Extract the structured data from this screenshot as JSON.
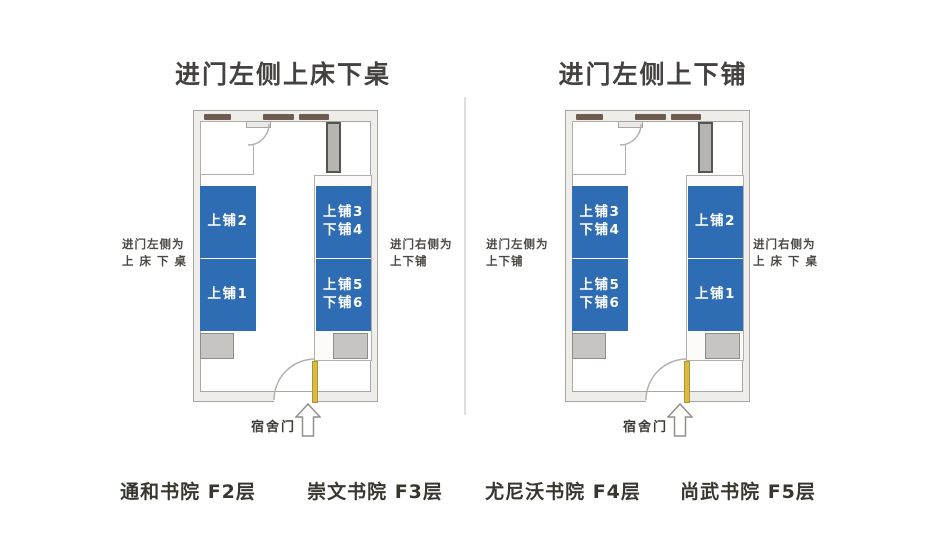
{
  "titles": {
    "left": "进门左侧上床下桌",
    "right": "进门左侧上下铺"
  },
  "rooms": [
    {
      "outer_label_left": {
        "line1": "进门左侧为",
        "line2": "上 床 下 桌"
      },
      "outer_label_right": {
        "line1": "进门右侧为",
        "line2": "上下铺"
      },
      "left_beds": [
        [
          "上铺2"
        ],
        [
          "上铺1"
        ]
      ],
      "right_beds": [
        [
          "上铺3",
          "下铺4"
        ],
        [
          "上铺5",
          "下铺6"
        ]
      ],
      "door_label": "宿舍门"
    },
    {
      "outer_label_left": {
        "line1": "进门左侧为",
        "line2": "上下铺"
      },
      "outer_label_right": {
        "line1": "进门右侧为",
        "line2": "上 床 下 桌"
      },
      "left_beds": [
        [
          "上铺3",
          "下铺4"
        ],
        [
          "上铺5",
          "下铺6"
        ]
      ],
      "right_beds": [
        [
          "上铺2"
        ],
        [
          "上铺1"
        ]
      ],
      "door_label": "宿舍门"
    }
  ],
  "captions": [
    "通和书院 F2层",
    "崇文书院 F3层",
    "尤尼沃书院 F4层",
    "尚武书院 F5层"
  ],
  "colors": {
    "bed_blue": "#2e6cb4",
    "desk_gray": "#c7c5c2",
    "wardrobe_gray": "#b7b5b1",
    "door_yellow": "#ddba3e",
    "window_brown": "#6e5c50",
    "wall_line": "#a9a6a2",
    "text_dark": "#39352f"
  }
}
